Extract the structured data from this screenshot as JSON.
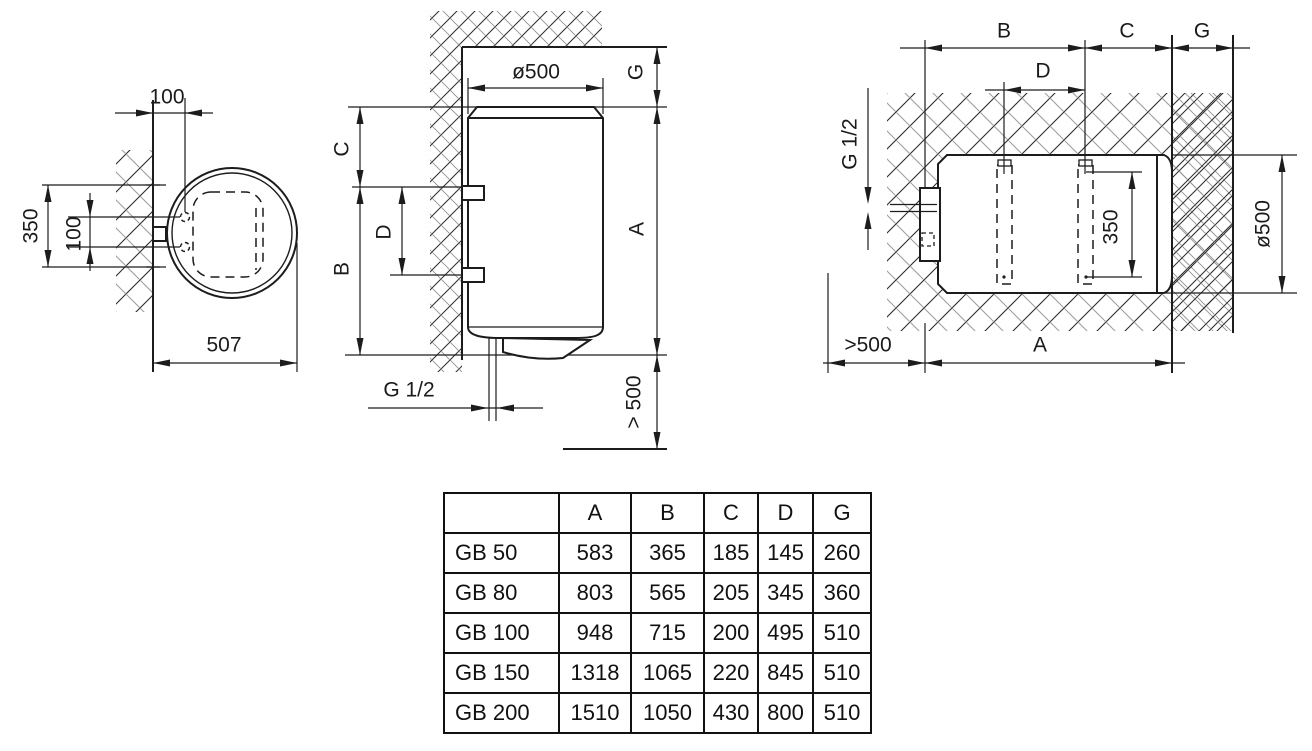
{
  "front_view": {
    "offset_from_wall": "100",
    "bracket_span": "350",
    "port_spacing": "100",
    "depth": "507"
  },
  "side_view": {
    "diameter": "ø500",
    "dim_g": "G",
    "dim_c": "C",
    "dim_d": "D",
    "dim_b": "B",
    "dim_a": "A",
    "pipe_thread": "G 1/2",
    "bottom_clearance": "> 500"
  },
  "horizontal_view": {
    "dim_b": "B",
    "dim_c": "C",
    "dim_g": "G",
    "dim_d": "D",
    "pipe_thread": "G 1/2",
    "slot_span": "350",
    "diameter": "ø500",
    "side_clearance": ">500",
    "dim_a": "A"
  },
  "table": {
    "columns": [
      "",
      "A",
      "B",
      "C",
      "D",
      "G"
    ],
    "rows": [
      {
        "model": "GB 50",
        "values": [
          "583",
          "365",
          "185",
          "145",
          "260"
        ]
      },
      {
        "model": "GB 80",
        "values": [
          "803",
          "565",
          "205",
          "345",
          "360"
        ]
      },
      {
        "model": "GB 100",
        "values": [
          "948",
          "715",
          "200",
          "495",
          "510"
        ]
      },
      {
        "model": "GB 150",
        "values": [
          "1318",
          "1065",
          "220",
          "845",
          "510"
        ]
      },
      {
        "model": "GB 200",
        "values": [
          "1510",
          "1050",
          "430",
          "800",
          "510"
        ]
      }
    ]
  },
  "colors": {
    "line": "#1c1c1c",
    "background": "#ffffff"
  }
}
